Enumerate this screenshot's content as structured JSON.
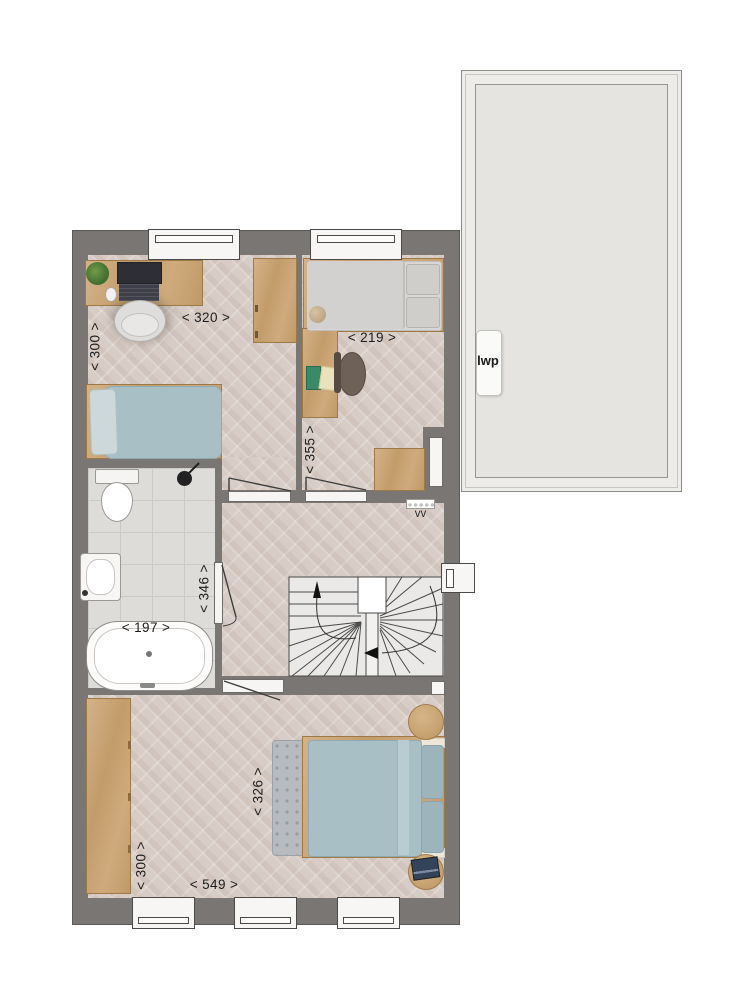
{
  "labels": {
    "bedroom_top_left": {
      "width": "< 320 >",
      "depth": "< 300 >"
    },
    "bedroom_top_right": {
      "width": "< 219 >",
      "depth": "< 355 >"
    },
    "bathroom": {
      "width": "< 197 >",
      "depth": "< 346 >"
    },
    "master_bedroom": {
      "bed_zone_depth": "< 326 >",
      "width": "< 549 >",
      "depth": "< 300 >"
    },
    "heat_pump": "lwp",
    "ventilation": "vv"
  },
  "colors": {
    "wall": "#7a7673",
    "wood_floor": "#d8cdc6",
    "tile_floor": "#dedcd9",
    "furniture_wood": "#c9a87c",
    "bedding_blue": "#a9bfc6",
    "bedding_gray": "#d6d5d3",
    "roof_panel": "#e5e4e0"
  }
}
